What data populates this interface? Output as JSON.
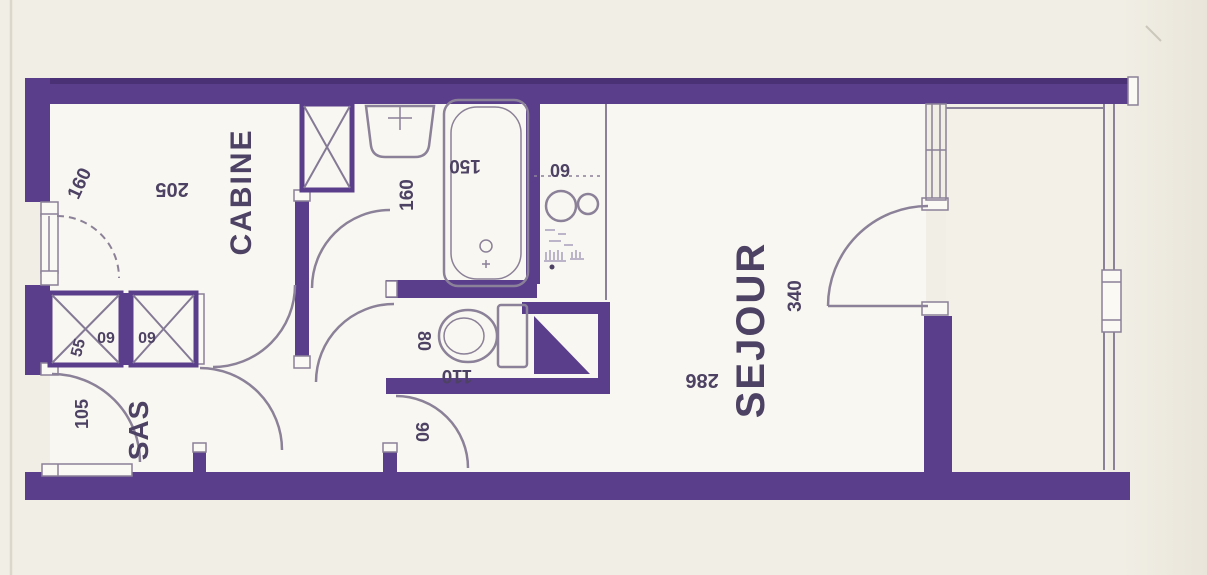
{
  "title": "apartment-floor-plan",
  "colors": {
    "wall": "#5a3e8c",
    "bg": "#f1eee5",
    "room": "#f9f7f1",
    "balcony": "#f3f0e8",
    "line": "#8b8198",
    "text": "#4d4263"
  },
  "labels": {
    "cabine": "CABINE",
    "cabine_width": "205",
    "cabine_window": "160",
    "bath_width": "160",
    "bathtub": "150",
    "kitchen_counter": "60",
    "closet_depth": "55",
    "closet1_width": "60",
    "closet2_width": "60",
    "sas": "SAS",
    "sas_door": "105",
    "wc_width": "80",
    "wc_length": "110",
    "sejour_door": "90",
    "sejour": "SEJOUR",
    "sejour_length": "286",
    "sejour_width": "340"
  }
}
